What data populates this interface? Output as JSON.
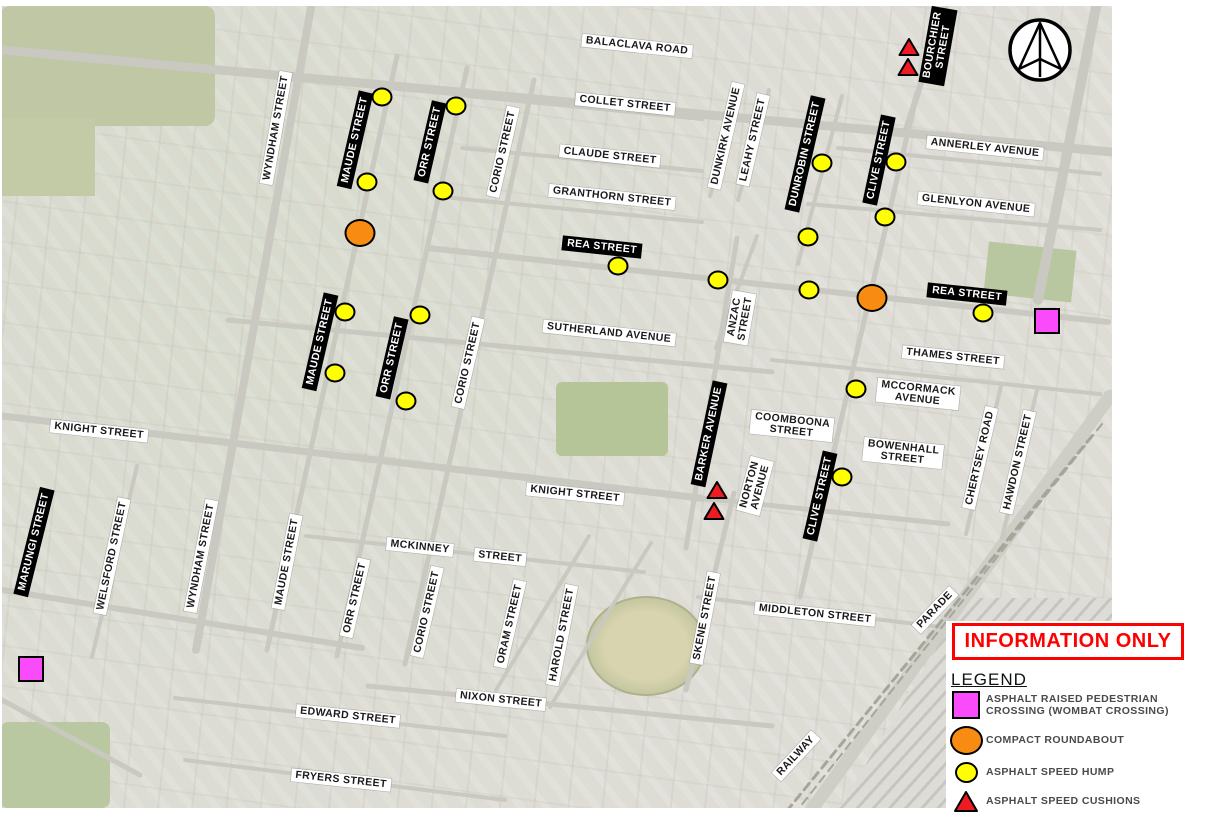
{
  "banner": {
    "text": "INFORMATION ONLY"
  },
  "legend": {
    "title": "LEGEND",
    "items": [
      {
        "shape": "square",
        "type": "wombat_crossing",
        "label_lines": [
          "ASPHALT RAISED PEDESTRIAN",
          "CROSSING (WOMBAT CROSSING)"
        ]
      },
      {
        "shape": "ellipse",
        "type": "compact_roundabout",
        "label_lines": [
          "COMPACT ROUNDABOUT"
        ]
      },
      {
        "shape": "circle",
        "type": "speed_hump",
        "label_lines": [
          "ASPHALT SPEED HUMP"
        ]
      },
      {
        "shape": "triangle",
        "type": "speed_cushion",
        "label_lines": [
          "ASPHALT SPEED CUSHIONS"
        ]
      }
    ]
  },
  "map": {
    "marker_colors": {
      "speed_hump": "#ffff00",
      "compact_roundabout": "#f88c12",
      "wombat_crossing": "#fa4bfa",
      "speed_cushion": "#ee1c22"
    },
    "street_labels": [
      {
        "text": "BALACLAVA ROAD",
        "x": 637,
        "y": 46,
        "rot": 6,
        "style": "w"
      },
      {
        "text": "COLLET STREET",
        "x": 625,
        "y": 104,
        "rot": 6,
        "style": "w"
      },
      {
        "text": "CLAUDE STREET",
        "x": 610,
        "y": 156,
        "rot": 6,
        "style": "w"
      },
      {
        "text": "GRANTHORN STREET",
        "x": 612,
        "y": 197,
        "rot": 6,
        "style": "w"
      },
      {
        "text": "REA STREET",
        "x": 602,
        "y": 247,
        "rot": 6,
        "style": "b"
      },
      {
        "text": "REA STREET",
        "x": 967,
        "y": 294,
        "rot": 6,
        "style": "b"
      },
      {
        "text": "DUNKIRK AVENUE",
        "x": 726,
        "y": 136,
        "rot": -77,
        "style": "w"
      },
      {
        "text": "LEAHY STREET",
        "x": 753,
        "y": 140,
        "rot": -77,
        "style": "w"
      },
      {
        "text": "DUNROBIN STREET",
        "x": 805,
        "y": 154,
        "rot": -77,
        "style": "b"
      },
      {
        "text": "CLIVE STREET",
        "x": 879,
        "y": 160,
        "rot": -78,
        "style": "b"
      },
      {
        "text": "BOURCHIER STREET",
        "x": 938,
        "y": 46,
        "rot": -80,
        "style": "b",
        "lines": [
          "BOURCHIER",
          "STREET"
        ]
      },
      {
        "text": "ANNERLEY AVENUE",
        "x": 985,
        "y": 148,
        "rot": 6,
        "style": "w"
      },
      {
        "text": "GLENLYON AVENUE",
        "x": 976,
        "y": 204,
        "rot": 6,
        "style": "w"
      },
      {
        "text": "MAUDE STREET",
        "x": 355,
        "y": 140,
        "rot": -77,
        "style": "b"
      },
      {
        "text": "ORR STREET",
        "x": 430,
        "y": 142,
        "rot": -77,
        "style": "b"
      },
      {
        "text": "WYNDHAM STREET",
        "x": 276,
        "y": 128,
        "rot": -80,
        "style": "w"
      },
      {
        "text": "CORIO STREET",
        "x": 503,
        "y": 152,
        "rot": -77,
        "style": "w"
      },
      {
        "text": "SUTHERLAND AVENUE",
        "x": 609,
        "y": 333,
        "rot": 6,
        "style": "w"
      },
      {
        "text": "ANZAC STREET",
        "x": 740,
        "y": 318,
        "rot": -80,
        "style": "w",
        "lines": [
          "ANZAC",
          "STREET"
        ]
      },
      {
        "text": "THAMES STREET",
        "x": 953,
        "y": 357,
        "rot": 6,
        "style": "w"
      },
      {
        "text": "MCCORMACK AVENUE",
        "x": 918,
        "y": 394,
        "rot": 6,
        "style": "w",
        "lines": [
          "MCCORMACK",
          "AVENUE"
        ]
      },
      {
        "text": "MAUDE STREET",
        "x": 320,
        "y": 342,
        "rot": -77,
        "style": "b"
      },
      {
        "text": "ORR STREET",
        "x": 392,
        "y": 358,
        "rot": -77,
        "style": "b"
      },
      {
        "text": "CORIO STREET",
        "x": 468,
        "y": 363,
        "rot": -77,
        "style": "w"
      },
      {
        "text": "COOMBOONA STREET",
        "x": 792,
        "y": 426,
        "rot": 6,
        "style": "w",
        "lines": [
          "COOMBOONA",
          "STREET"
        ]
      },
      {
        "text": "BOWENHALL STREET",
        "x": 903,
        "y": 453,
        "rot": 6,
        "style": "w",
        "lines": [
          "BOWENHALL",
          "STREET"
        ]
      },
      {
        "text": "BARKER AVENUE",
        "x": 709,
        "y": 434,
        "rot": -78,
        "style": "b"
      },
      {
        "text": "NORTON AVENUE",
        "x": 755,
        "y": 486,
        "rot": -75,
        "style": "w",
        "lines": [
          "NORTON",
          "AVENUE"
        ]
      },
      {
        "text": "CHERTSEY ROAD",
        "x": 980,
        "y": 458,
        "rot": -77,
        "style": "w"
      },
      {
        "text": "HAWDON STREET",
        "x": 1018,
        "y": 462,
        "rot": -77,
        "style": "w"
      },
      {
        "text": "KNIGHT STREET",
        "x": 99,
        "y": 431,
        "rot": 6,
        "style": "w"
      },
      {
        "text": "KNIGHT STREET",
        "x": 575,
        "y": 494,
        "rot": 6,
        "style": "w"
      },
      {
        "text": "CLIVE STREET",
        "x": 820,
        "y": 496,
        "rot": -77,
        "style": "b"
      },
      {
        "text": "MARUNGI STREET",
        "x": 34,
        "y": 542,
        "rot": -76,
        "style": "b"
      },
      {
        "text": "WELSFORD STREET",
        "x": 112,
        "y": 556,
        "rot": -78,
        "style": "w"
      },
      {
        "text": "WYNDHAM STREET",
        "x": 201,
        "y": 556,
        "rot": -79,
        "style": "w"
      },
      {
        "text": "MAUDE STREET",
        "x": 287,
        "y": 562,
        "rot": -79,
        "style": "w"
      },
      {
        "text": "MCKINNEY",
        "x": 420,
        "y": 547,
        "rot": 6,
        "style": "w"
      },
      {
        "text": "STREET",
        "x": 500,
        "y": 557,
        "rot": 6,
        "style": "w"
      },
      {
        "text": "ORR STREET",
        "x": 355,
        "y": 598,
        "rot": -77,
        "style": "w"
      },
      {
        "text": "CORIO STREET",
        "x": 427,
        "y": 612,
        "rot": -77,
        "style": "w"
      },
      {
        "text": "ORAM STREET",
        "x": 510,
        "y": 624,
        "rot": -77,
        "style": "w"
      },
      {
        "text": "HAROLD STREET",
        "x": 562,
        "y": 635,
        "rot": -79,
        "style": "w"
      },
      {
        "text": "SKENE STREET",
        "x": 705,
        "y": 618,
        "rot": -79,
        "style": "w"
      },
      {
        "text": "NIXON STREET",
        "x": 501,
        "y": 700,
        "rot": 6,
        "style": "w"
      },
      {
        "text": "MIDDLETON STREET",
        "x": 815,
        "y": 614,
        "rot": 6,
        "style": "w"
      },
      {
        "text": "PARADE",
        "x": 935,
        "y": 610,
        "rot": -46,
        "style": "w"
      },
      {
        "text": "EDWARD STREET",
        "x": 348,
        "y": 716,
        "rot": 6,
        "style": "w"
      },
      {
        "text": "FRYERS STREET",
        "x": 341,
        "y": 780,
        "rot": 6,
        "style": "w"
      },
      {
        "text": "RAILWAY",
        "x": 796,
        "y": 756,
        "rot": -47,
        "style": "w"
      }
    ],
    "markers": {
      "speed_humps": [
        {
          "x": 382,
          "y": 97
        },
        {
          "x": 456,
          "y": 106
        },
        {
          "x": 367,
          "y": 182
        },
        {
          "x": 443,
          "y": 191
        },
        {
          "x": 822,
          "y": 163
        },
        {
          "x": 896,
          "y": 162
        },
        {
          "x": 885,
          "y": 217
        },
        {
          "x": 808,
          "y": 237
        },
        {
          "x": 618,
          "y": 266
        },
        {
          "x": 718,
          "y": 280
        },
        {
          "x": 809,
          "y": 290
        },
        {
          "x": 983,
          "y": 313
        },
        {
          "x": 856,
          "y": 389
        },
        {
          "x": 345,
          "y": 312
        },
        {
          "x": 420,
          "y": 315
        },
        {
          "x": 335,
          "y": 373
        },
        {
          "x": 406,
          "y": 401
        },
        {
          "x": 842,
          "y": 477
        }
      ],
      "compact_roundabouts": [
        {
          "x": 360,
          "y": 233
        },
        {
          "x": 872,
          "y": 298
        }
      ],
      "wombat_crossings": [
        {
          "x": 1047,
          "y": 321
        },
        {
          "x": 31,
          "y": 669
        }
      ],
      "speed_cushions": [
        {
          "x": 909,
          "y": 47
        },
        {
          "x": 908,
          "y": 67
        },
        {
          "x": 717,
          "y": 490
        },
        {
          "x": 714,
          "y": 511
        }
      ]
    }
  }
}
